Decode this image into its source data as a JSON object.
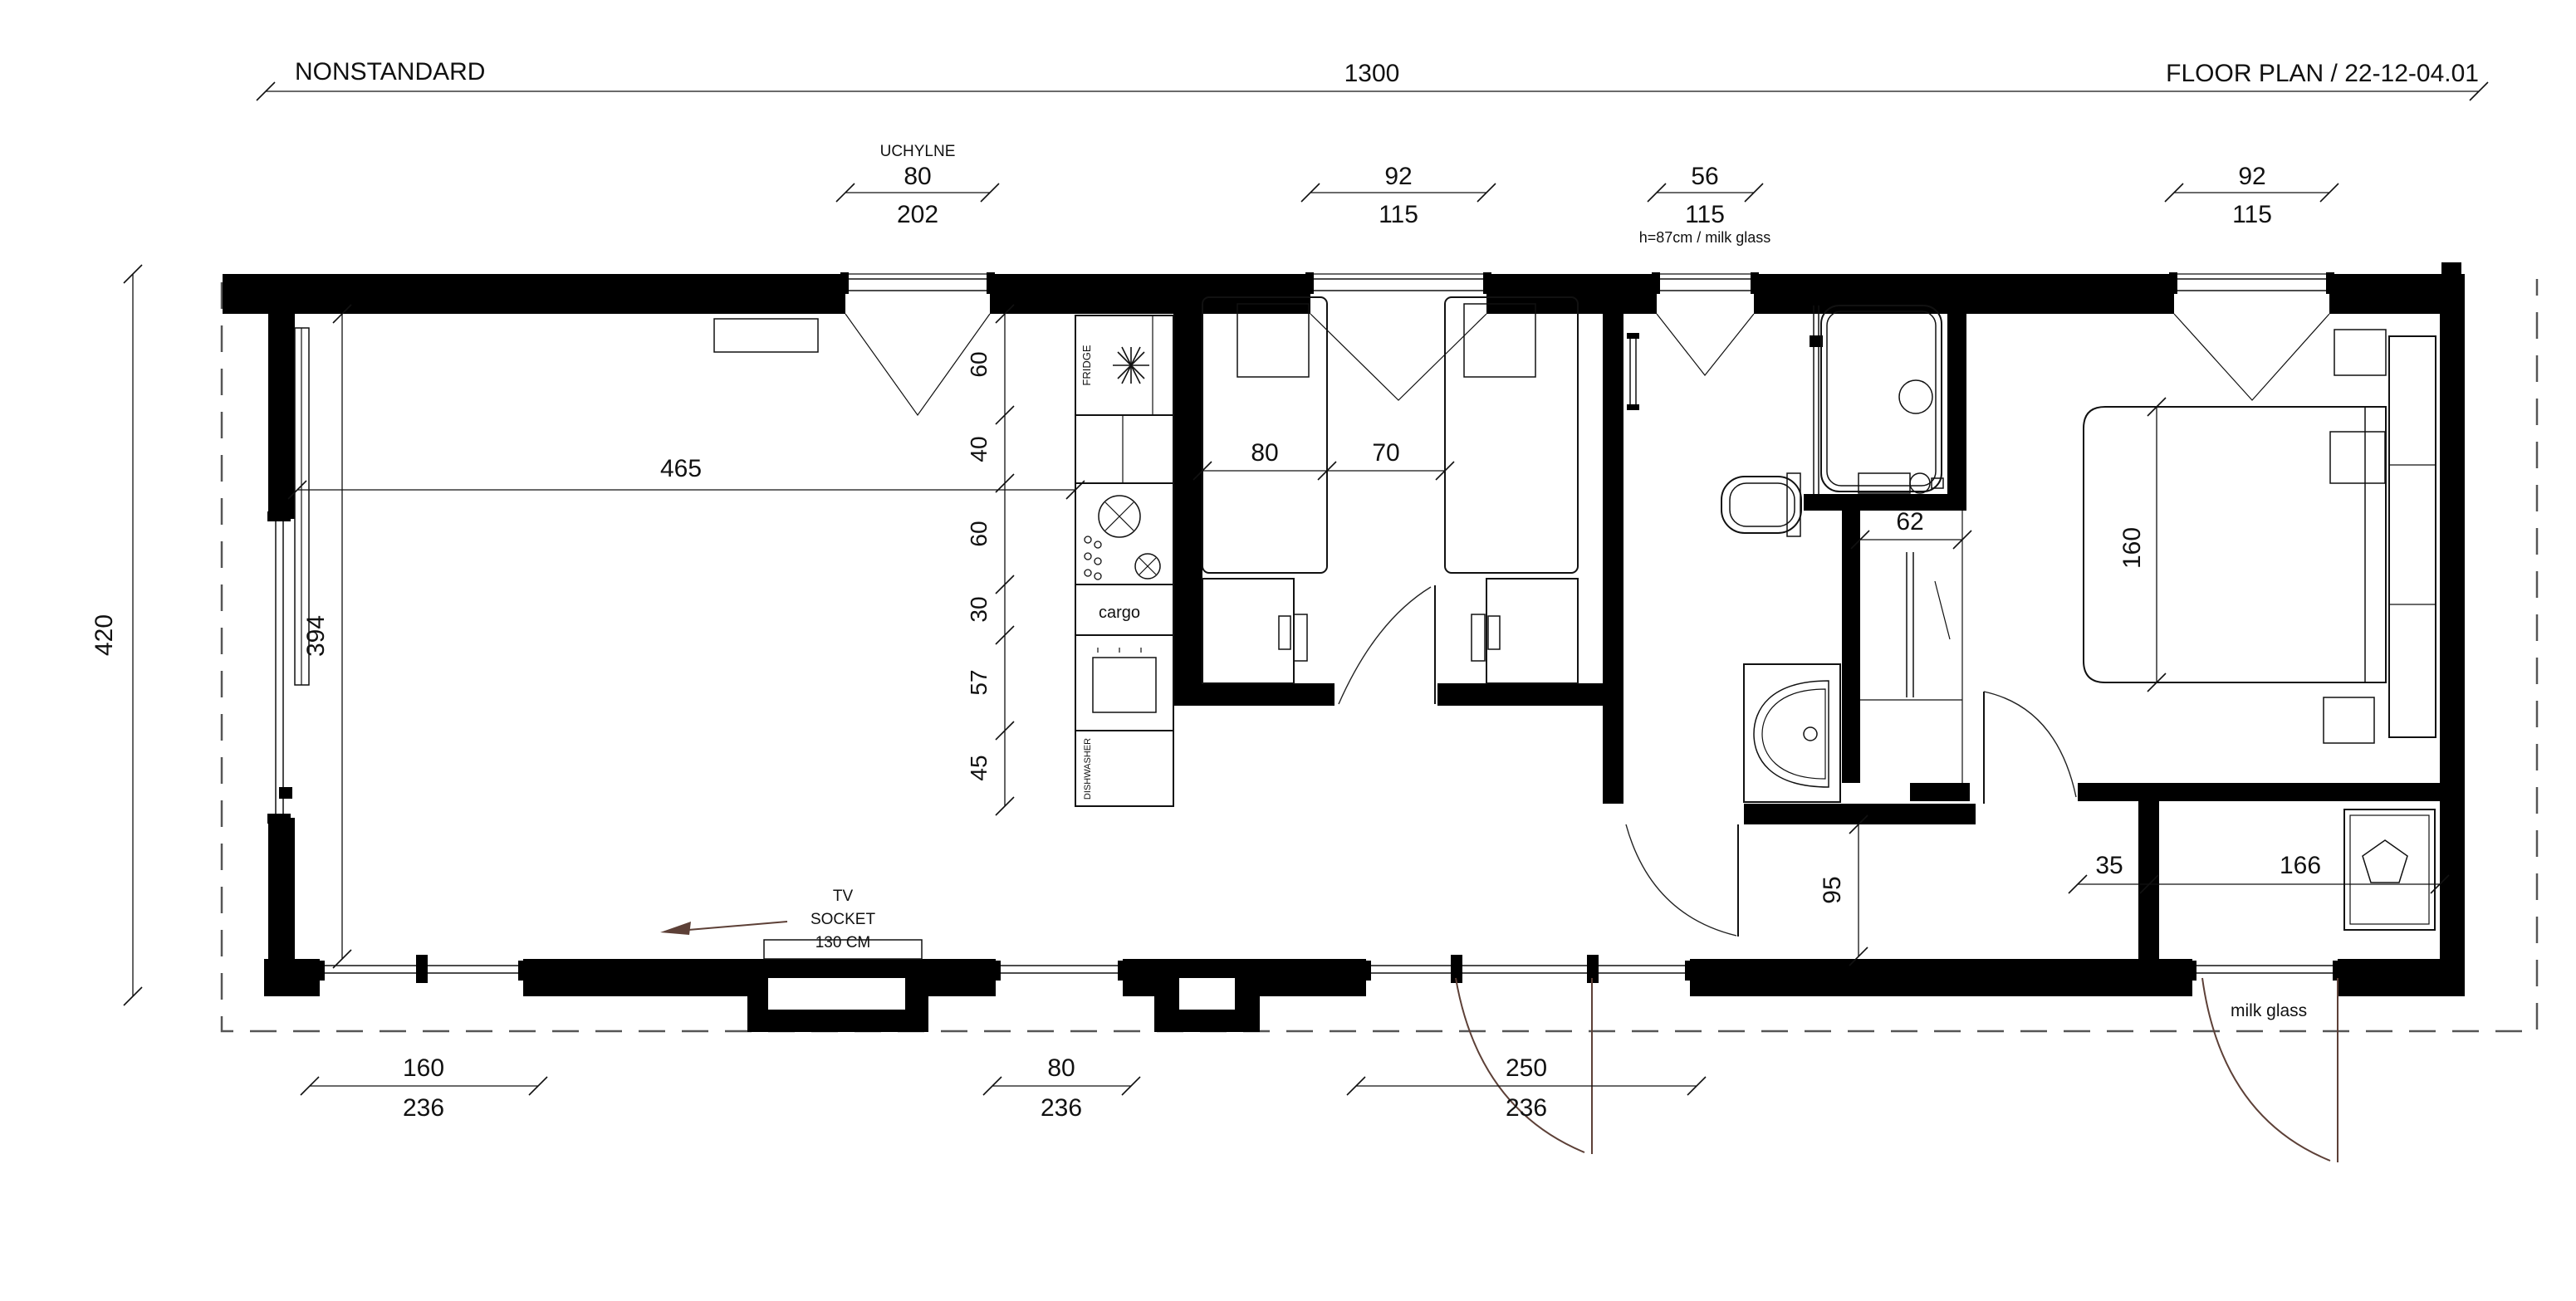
{
  "header": {
    "project": "NONSTANDARD",
    "overall_width": "1300",
    "title": "FLOOR PLAN / 22-12-04.01"
  },
  "top_dims": {
    "uchylne": {
      "label": "UCHYLNE",
      "clear": "80",
      "rough": "202"
    },
    "kids_window": {
      "clear": "92",
      "rough": "115"
    },
    "bath_window": {
      "clear": "56",
      "rough": "115",
      "note": "h=87cm / milk glass"
    },
    "bedroom_window": {
      "clear": "92",
      "rough": "115"
    }
  },
  "left_dims": {
    "overall_height": "420",
    "interior_height": "394"
  },
  "living_room": {
    "width": "465"
  },
  "tv": {
    "line1": "TV",
    "line2": "SOCKET",
    "line3": "130 CM"
  },
  "kitchen": {
    "fridge": "FRIDGE",
    "cargo": "cargo",
    "dishwasher": "DISHWASHER",
    "segments": [
      "60",
      "40",
      "60",
      "30",
      "57",
      "45"
    ]
  },
  "kids_room": {
    "bed_width": "80",
    "aisle": "70"
  },
  "bathroom": {
    "closet_width": "62"
  },
  "bedroom": {
    "bed_width": "160"
  },
  "hall": {
    "width": "95",
    "wall_offset": "35",
    "tech_room_width": "166"
  },
  "tech_room": {
    "door_note": "milk glass"
  },
  "bottom_dims": {
    "slide_door": {
      "clear": "160",
      "rough": "236"
    },
    "window80": {
      "clear": "80",
      "rough": "236"
    },
    "entry_door": {
      "clear": "250",
      "rough": "236"
    }
  }
}
